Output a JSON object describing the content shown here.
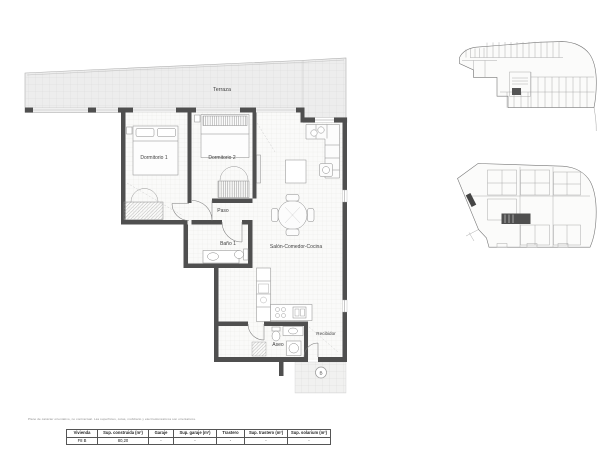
{
  "plan": {
    "rooms": {
      "terraza": "Terraza",
      "dormitorio1": "Dormitorio 1",
      "dormitorio2": "Dormitorio 2",
      "paso": "Paso",
      "bano1": "Baño 1",
      "salon": "Salón-Comedor-Cocina",
      "aseo": "Aseo",
      "recibidor": "Recibidor"
    },
    "entrance_marker": "B"
  },
  "footnote": "Plano de carácter orientativo, no contractual. Las superficies, cotas, mobiliario y electrodomésticos son orientativos.",
  "table": {
    "headers": [
      "Vivienda",
      "Sup. construida (m²)",
      "Garaje",
      "Sup. garaje (m²)",
      "Trastero",
      "Sup. trastero (m²)",
      "Sup. solarium (m²)"
    ],
    "row": [
      "F8 B",
      "80,20",
      "-",
      "-",
      "-",
      "-",
      "-"
    ]
  },
  "colors": {
    "wall": "#4f4f4f",
    "terrace_fill": "#ededed",
    "floor_grid": "#e3e3e1",
    "line": "#8c8c8c"
  }
}
